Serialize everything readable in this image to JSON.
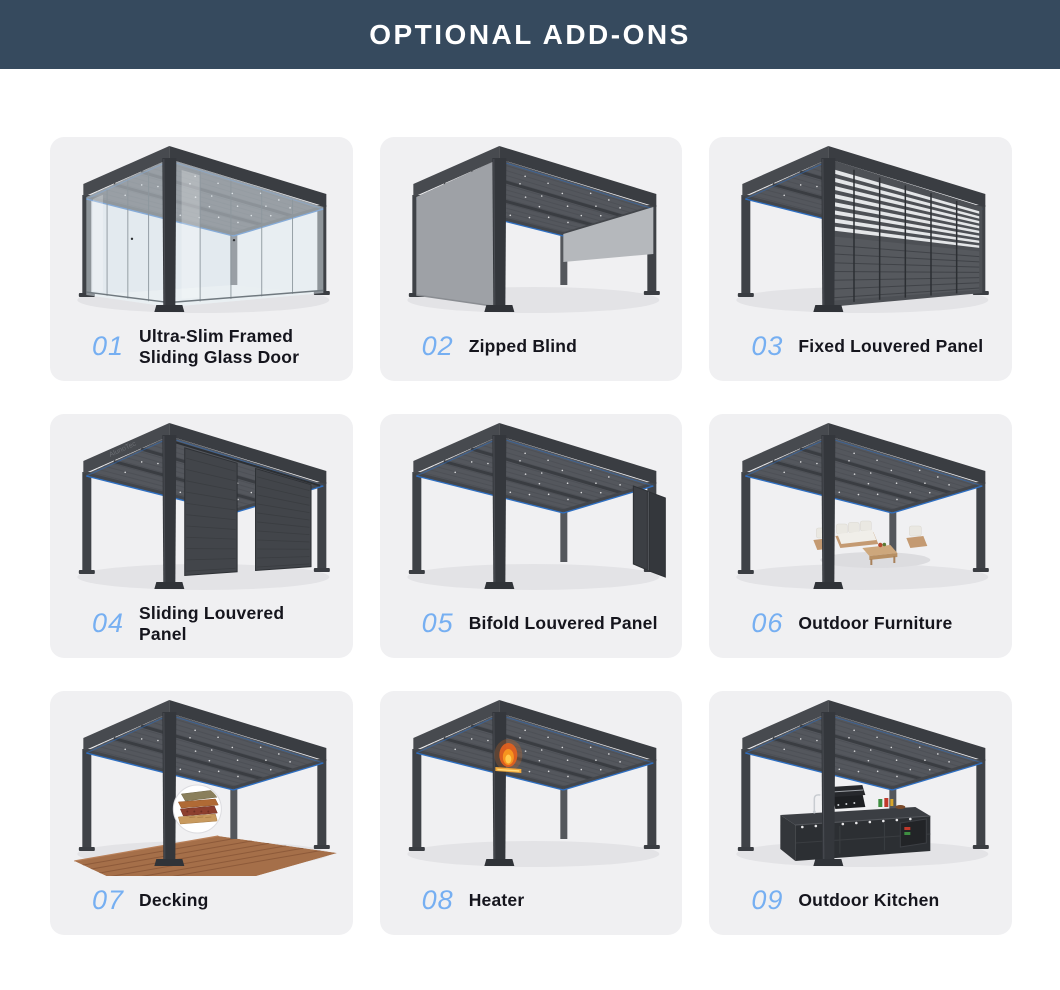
{
  "header": {
    "title": "OPTIONAL ADD-ONS"
  },
  "colors": {
    "header_bg": "#364a5e",
    "header_text": "#ffffff",
    "card_bg": "#f0f0f2",
    "number_color": "#76aff2",
    "label_color": "#15151d",
    "frame_dark": "#3b3e43",
    "led_blue": "#2f6fc1"
  },
  "cards": [
    {
      "number": "01",
      "label": "Ultra-Slim Framed Sliding Glass Door",
      "illustration": "pergola-glass-door"
    },
    {
      "number": "02",
      "label": "Zipped Blind",
      "illustration": "pergola-zipped-blind"
    },
    {
      "number": "03",
      "label": "Fixed Louvered Panel",
      "illustration": "pergola-fixed-louvered"
    },
    {
      "number": "04",
      "label": "Sliding Louvered Panel",
      "illustration": "pergola-sliding-louvered",
      "watermark": "AlunoTec"
    },
    {
      "number": "05",
      "label": "Bifold Louvered Panel",
      "illustration": "pergola-bifold-louvered"
    },
    {
      "number": "06",
      "label": "Outdoor Furniture",
      "illustration": "pergola-outdoor-furniture"
    },
    {
      "number": "07",
      "label": "Decking",
      "illustration": "pergola-decking"
    },
    {
      "number": "08",
      "label": "Heater",
      "illustration": "pergola-heater"
    },
    {
      "number": "09",
      "label": "Outdoor Kitchen",
      "illustration": "pergola-outdoor-kitchen"
    }
  ]
}
